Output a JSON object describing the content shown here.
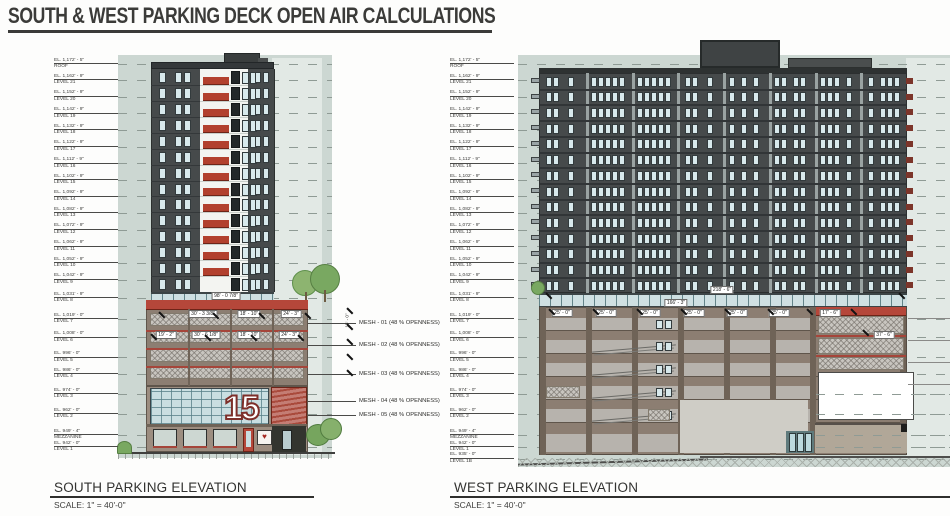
{
  "page": {
    "title": "SOUTH & WEST PARKING DECK OPEN AIR CALCULATIONS"
  },
  "colors": {
    "background_band": "#ccd7d2",
    "light_band": "#e2e9e5",
    "tower_dark": "#464a4b",
    "white_facade": "#f3f4f1",
    "balcony_red": "#b2402e",
    "parapet_red": "#b5473a",
    "deck_taupe": "#8c7e72",
    "deck_opening": "#b7b3ad",
    "mesh_gray": "#c8c5bf",
    "glass_blue": "#c9dee1",
    "title_ink": "#3b3b39"
  },
  "levels": [
    {
      "ft": 1172.417,
      "el": "EL. 1,172' - 5\"",
      "name": "ROOF"
    },
    {
      "ft": 1162.75,
      "el": "EL. 1,162' - 9\"",
      "name": "LEVEL 21"
    },
    {
      "ft": 1152.75,
      "el": "EL. 1,152' - 9\"",
      "name": "LEVEL 20"
    },
    {
      "ft": 1142.75,
      "el": "EL. 1,142' - 9\"",
      "name": "LEVEL 19"
    },
    {
      "ft": 1132.75,
      "el": "EL. 1,132' - 9\"",
      "name": "LEVEL 18"
    },
    {
      "ft": 1122.75,
      "el": "EL. 1,122' - 9\"",
      "name": "LEVEL 17"
    },
    {
      "ft": 1112.75,
      "el": "EL. 1,112' - 9\"",
      "name": "LEVEL 16"
    },
    {
      "ft": 1102.75,
      "el": "EL. 1,102' - 9\"",
      "name": "LEVEL 15"
    },
    {
      "ft": 1092.75,
      "el": "EL. 1,092' - 9\"",
      "name": "LEVEL 14"
    },
    {
      "ft": 1082.75,
      "el": "EL. 1,082' - 9\"",
      "name": "LEVEL 13"
    },
    {
      "ft": 1072.75,
      "el": "EL. 1,072' - 9\"",
      "name": "LEVEL 12"
    },
    {
      "ft": 1062.75,
      "el": "EL. 1,062' - 9\"",
      "name": "LEVEL 11"
    },
    {
      "ft": 1052.75,
      "el": "EL. 1,052' - 9\"",
      "name": "LEVEL 10"
    },
    {
      "ft": 1042.75,
      "el": "EL. 1,042' - 9\"",
      "name": "LEVEL 9"
    },
    {
      "ft": 1031.75,
      "el": "EL. 1,031' - 9\"",
      "name": "LEVEL 8"
    },
    {
      "ft": 1019.0,
      "el": "EL. 1,019' - 0\"",
      "name": "LEVEL 7"
    },
    {
      "ft": 1008.0,
      "el": "EL. 1,008' - 0\"",
      "name": "LEVEL 6"
    },
    {
      "ft": 996.0,
      "el": "EL. 996' - 0\"",
      "name": "LEVEL 5"
    },
    {
      "ft": 986.0,
      "el": "EL. 986' - 0\"",
      "name": "LEVEL 4"
    },
    {
      "ft": 974.0,
      "el": "EL. 974' - 0\"",
      "name": "LEVEL 3"
    },
    {
      "ft": 962.0,
      "el": "EL. 962' - 0\"",
      "name": "LEVEL 2"
    },
    {
      "ft": 949.33,
      "el": "EL. 949' - 4\"",
      "name": "MEZZANINE"
    },
    {
      "ft": 942.0,
      "el": "EL. 942' - 0\"",
      "name": "LEVEL 1"
    }
  ],
  "elevations": {
    "south": {
      "name": "SOUTH PARKING ELEVATION",
      "scale": "SCALE:  1\" = 40'-0\"",
      "mesh_notes": [
        {
          "label": "MESH - 01 (48 % OPENNESS)",
          "y": 320
        },
        {
          "label": "MESH - 02 (48 % OPENNESS)",
          "y": 342
        },
        {
          "label": "MESH - 03 (48 % OPENNESS)",
          "y": 371
        },
        {
          "label": "MESH - 04 (48 % OPENNESS)",
          "y": 398
        },
        {
          "label": "MESH - 05 (48 % OPENNESS)",
          "y": 412
        }
      ],
      "vertical_dim": {
        "label": "15' - 0\"",
        "x": 340,
        "y": 318
      },
      "dims": [
        {
          "label": "98' - 0 7/8\"",
          "x": 226,
          "y": 292
        },
        {
          "label": "30' - 3 3/8\"",
          "x": 203,
          "y": 310
        },
        {
          "label": "18' - 10\"",
          "x": 249,
          "y": 310
        },
        {
          "label": "24' - 3\"",
          "x": 291,
          "y": 310
        },
        {
          "label": "19' - 2\"",
          "x": 166,
          "y": 331
        },
        {
          "label": "30' - 6 1/8\"",
          "x": 206,
          "y": 331
        },
        {
          "label": "18' - 10\"",
          "x": 249,
          "y": 331
        },
        {
          "label": "24' - 3\"",
          "x": 289,
          "y": 331
        }
      ]
    },
    "west": {
      "name": "WEST PARKING ELEVATION",
      "scale": "SCALE:  1\" = 40'-0\"",
      "extra_levels": [
        {
          "ft": 935.0,
          "el": "EL. 935' - 0\"",
          "name": "LEVEL 1B"
        }
      ],
      "dims": [
        {
          "label": "218' - 6\"",
          "x": 722,
          "y": 286
        },
        {
          "label": "166' - 3\"",
          "x": 676,
          "y": 299
        },
        {
          "label": "25' - 0\"",
          "x": 562,
          "y": 309
        },
        {
          "label": "25' - 0\"",
          "x": 606,
          "y": 309
        },
        {
          "label": "25' - 0\"",
          "x": 650,
          "y": 309
        },
        {
          "label": "25' - 0\"",
          "x": 694,
          "y": 309
        },
        {
          "label": "25' - 0\"",
          "x": 737,
          "y": 309
        },
        {
          "label": "25' - 0\"",
          "x": 779,
          "y": 309
        },
        {
          "label": "17' - 6\"",
          "x": 830,
          "y": 309
        },
        {
          "label": "37' - 6\"",
          "x": 884,
          "y": 331
        }
      ]
    }
  }
}
